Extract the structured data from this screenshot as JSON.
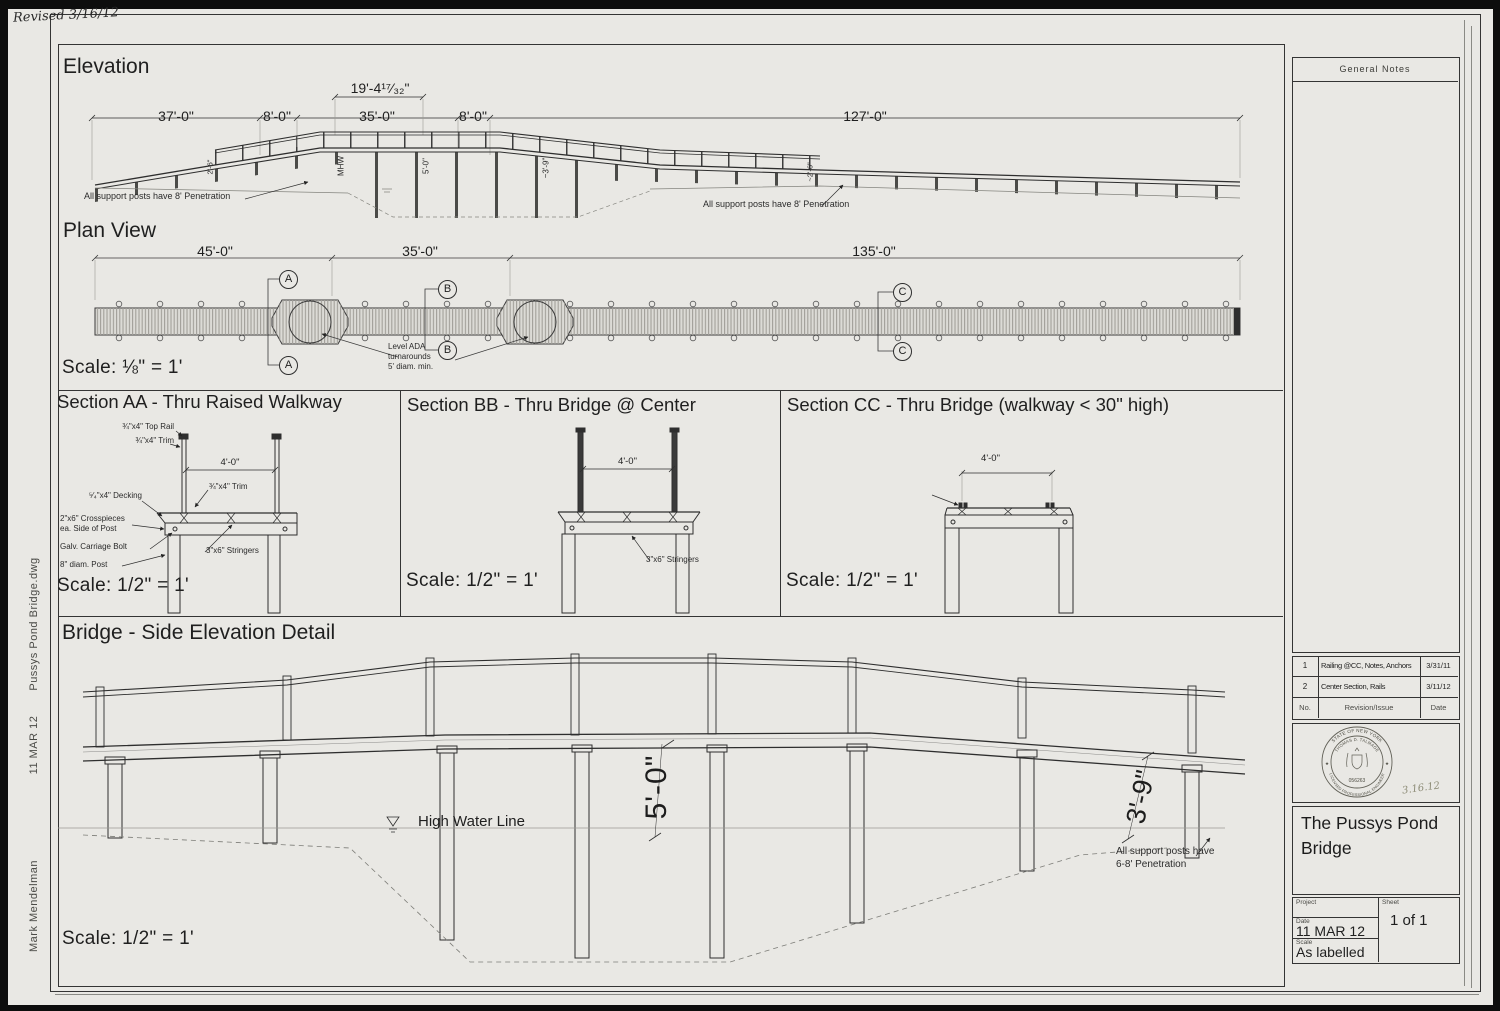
{
  "page": {
    "revised_note": "Revised 3/16/12",
    "margin_filename": "Pussys Pond Bridge.dwg",
    "margin_date": "11 MAR 12",
    "margin_author": "Mark Mendelman"
  },
  "elevation": {
    "title": "Elevation",
    "dim_top": "19'-4¹⁷⁄₃₂\"",
    "dim_1": "37'-0\"",
    "dim_2": "8'-0\"",
    "dim_3": "35'-0\"",
    "dim_4": "8'-0\"",
    "dim_5": "127'-0\"",
    "vdim_1": "2'-6\"",
    "vdim_mhw": "MHW",
    "vdim_2": "5'-0\"",
    "vdim_3": "~3'-9\"",
    "vdim_4": "~2'-6\"",
    "note_left": "All support posts have 8' Penetration",
    "note_right": "All support posts have 8' Penetration"
  },
  "plan": {
    "title": "Plan View",
    "dim_1": "45'-0\"",
    "dim_2": "35'-0\"",
    "dim_3": "135'-0\"",
    "marker_a": "A",
    "marker_b": "B",
    "marker_c": "C",
    "ada_note": "Level ADA\nturnarounds\n5' diam. min.",
    "scale": "Scale: ⅛\" = 1'"
  },
  "sections": {
    "aa": {
      "title": "Section AA - Thru Raised Walkway",
      "top_rail": "¾\"x4\" Top Rail",
      "trim": "¾\"x4\" Trim",
      "dim": "4'-0\"",
      "trim2": "¾\"x4\" Trim",
      "decking": "⁵⁄₄\"x4\" Decking",
      "crosspieces": "2\"x6\" Crosspieces\nea. Side of Post",
      "bolt": "Galv. Carriage Bolt",
      "post": "8\" diam. Post",
      "stringers": "3\"x6\" Stringers",
      "scale": "Scale: 1/2\" = 1'"
    },
    "bb": {
      "title": "Section BB - Thru Bridge @ Center",
      "dim": "4'-0\"",
      "stringers": "3\"x6\" Stringers",
      "scale": "Scale: 1/2\" = 1'"
    },
    "cc": {
      "title": "Section CC - Thru Bridge (walkway < 30\" high)",
      "dim": "4'-0\"",
      "ridge_note": "Raised ridge each side\nof walkway for wheelchairs",
      "scale": "Scale: 1/2\" = 1'"
    }
  },
  "side_detail": {
    "title": "Bridge - Side Elevation Detail",
    "water_label": "High Water Line",
    "dim_center": "5'-0\"",
    "dim_right": "3'-9\"",
    "note": "All support posts have\n6-8' Penetration",
    "scale": "Scale: 1/2\" = 1'"
  },
  "sidebar": {
    "notes_title": "General Notes",
    "revisions": [
      {
        "no": "1",
        "desc": "Railing @CC, Notes, Anchors",
        "date": "3/31/11"
      },
      {
        "no": "2",
        "desc": "Center Section, Rails",
        "date": "3/11/12"
      },
      {
        "no": "No.",
        "desc": "Revision/Issue",
        "date": "Date"
      }
    ],
    "seal": {
      "arc_top": "STATE OF NEW YORK",
      "name": "THOMAS D. TALMAGE",
      "number": "056263",
      "arc_bottom": "LICENSED PROFESSIONAL ENGINEER",
      "star": "★",
      "hand_date": "3.16.12"
    },
    "project_title": "The Pussys Pond Bridge",
    "labels": {
      "project": "Project",
      "sheet": "Sheet",
      "date": "Date",
      "scale": "Scale"
    },
    "values": {
      "sheet": "1 of 1",
      "date": "11 MAR 12",
      "scale": "As labelled"
    }
  }
}
